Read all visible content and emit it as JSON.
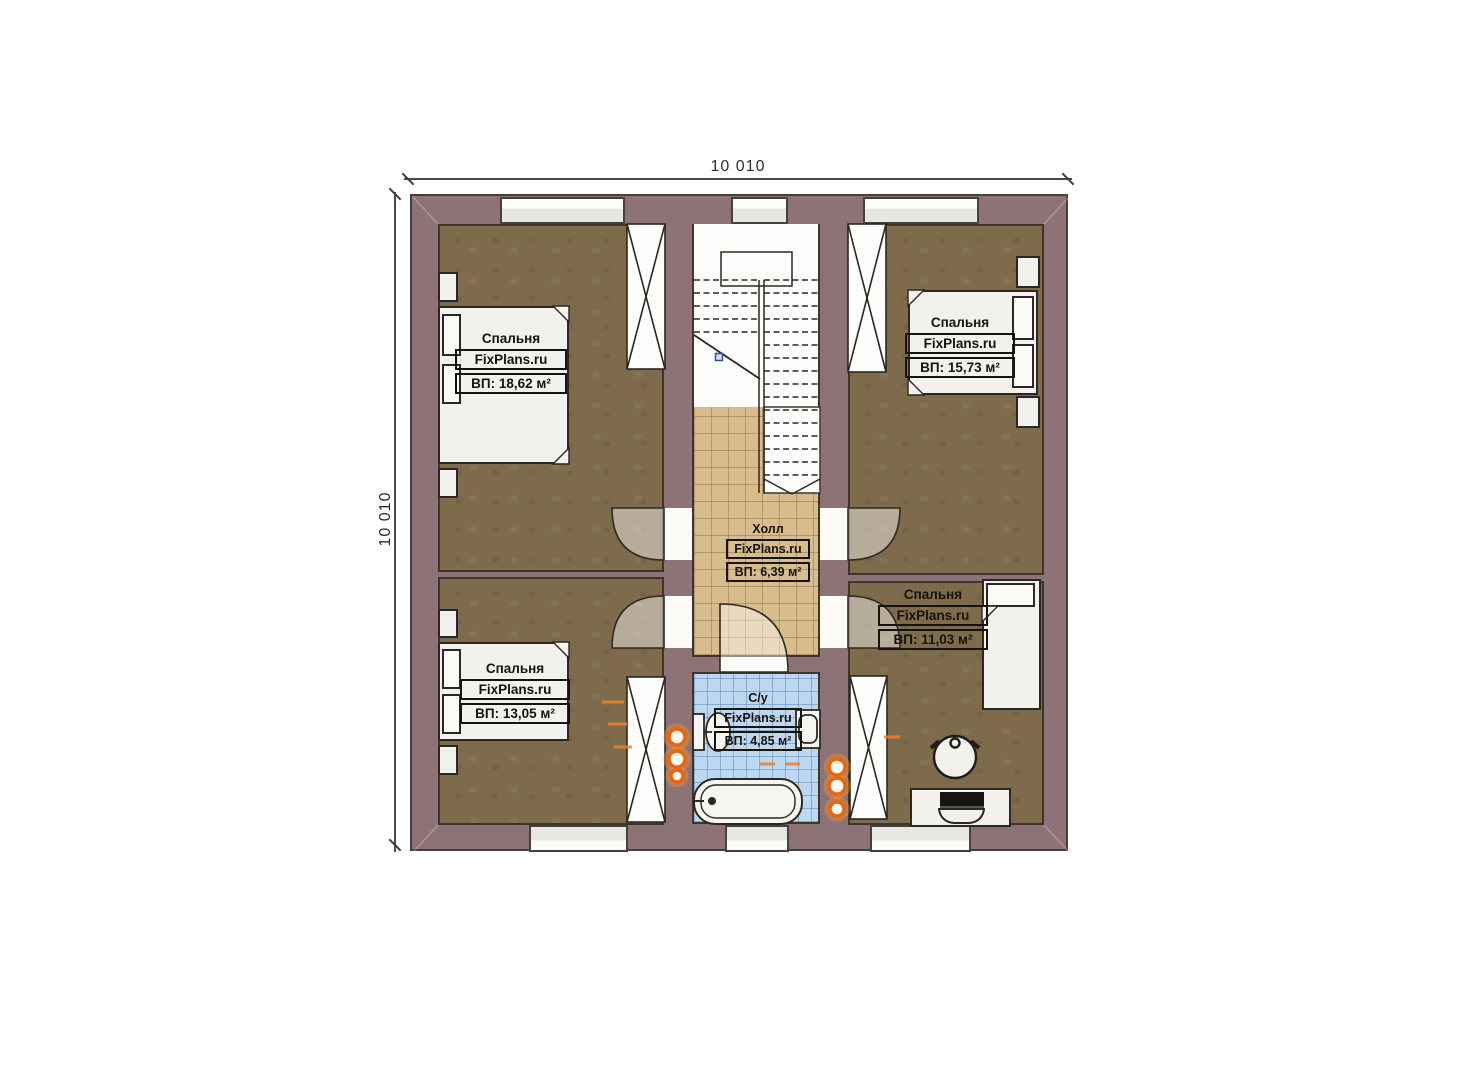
{
  "plan": {
    "type": "floor-plan-second-storey",
    "brand": "FixPlans.ru"
  },
  "dimensions": {
    "width_mm": "10 010",
    "height_mm": "10 010"
  },
  "rooms": [
    {
      "name": "Спальня",
      "brand": "FixPlans.ru",
      "area": "ВП: 18,62 м²"
    },
    {
      "name": "Спальня",
      "brand": "FixPlans.ru",
      "area": "ВП: 15,73 м²"
    },
    {
      "name": "Холл",
      "brand": "FixPlans.ru",
      "area": "ВП: 6,39 м²"
    },
    {
      "name": "Спальня",
      "brand": "FixPlans.ru",
      "area": "ВП: 11,03 м²"
    },
    {
      "name": "Спальня",
      "brand": "FixPlans.ru",
      "area": "ВП: 13,05 м²"
    },
    {
      "name": "С/у",
      "brand": "FixPlans.ru",
      "area": "ВП: 4,85 м²"
    }
  ],
  "colors": {
    "wall": "#8d7378",
    "bedroom_floor": "#7e6b4c",
    "hall_floor": "#d8bc8e",
    "bath_floor": "#bdd7f0",
    "furniture": "#f2f1ee",
    "radiator": "#e8650f",
    "ink": "#2c2722"
  }
}
